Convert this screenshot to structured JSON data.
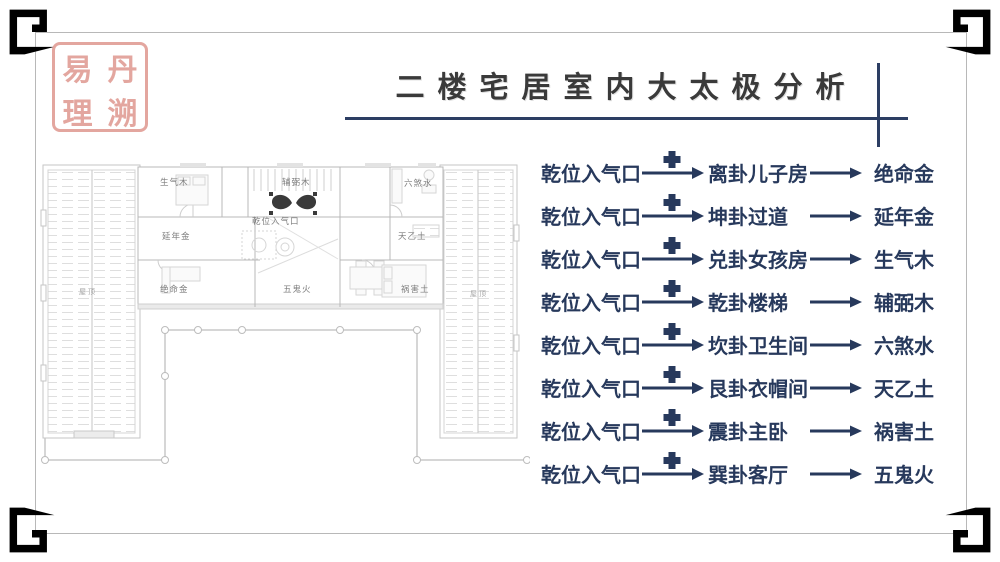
{
  "title": "二楼宅居室内大太极分析",
  "seal": {
    "top_left": "易",
    "top_right": "丹",
    "bottom_left": "理",
    "bottom_right": "溯"
  },
  "colors": {
    "accent": "#2c3e63",
    "list_text": "#27395c",
    "seal": "#e09a92",
    "frame": "#7d7d7d"
  },
  "floor_plan": {
    "labels": [
      "生气木",
      "辅弼木",
      "六煞水",
      "乾位入气口",
      "延年金",
      "天乙土",
      "绝命金",
      "五鬼火",
      "祸害土"
    ],
    "roof_label": "屋 顶"
  },
  "analysis_list": {
    "rows": [
      {
        "source": "乾位入气口",
        "target": "离卦儿子房",
        "result": "绝命金"
      },
      {
        "source": "乾位入气口",
        "target": "坤卦过道",
        "result": "延年金"
      },
      {
        "source": "乾位入气口",
        "target": "兑卦女孩房",
        "result": "生气木"
      },
      {
        "source": "乾位入气口",
        "target": "乾卦楼梯",
        "result": "辅弼木"
      },
      {
        "source": "乾位入气口",
        "target": "坎卦卫生间",
        "result": "六煞水"
      },
      {
        "source": "乾位入气口",
        "target": "艮卦衣帽间",
        "result": "天乙土"
      },
      {
        "source": "乾位入气口",
        "target": "震卦主卧",
        "result": "祸害土"
      },
      {
        "source": "乾位入气口",
        "target": "巽卦客厅",
        "result": "五鬼火"
      }
    ]
  }
}
